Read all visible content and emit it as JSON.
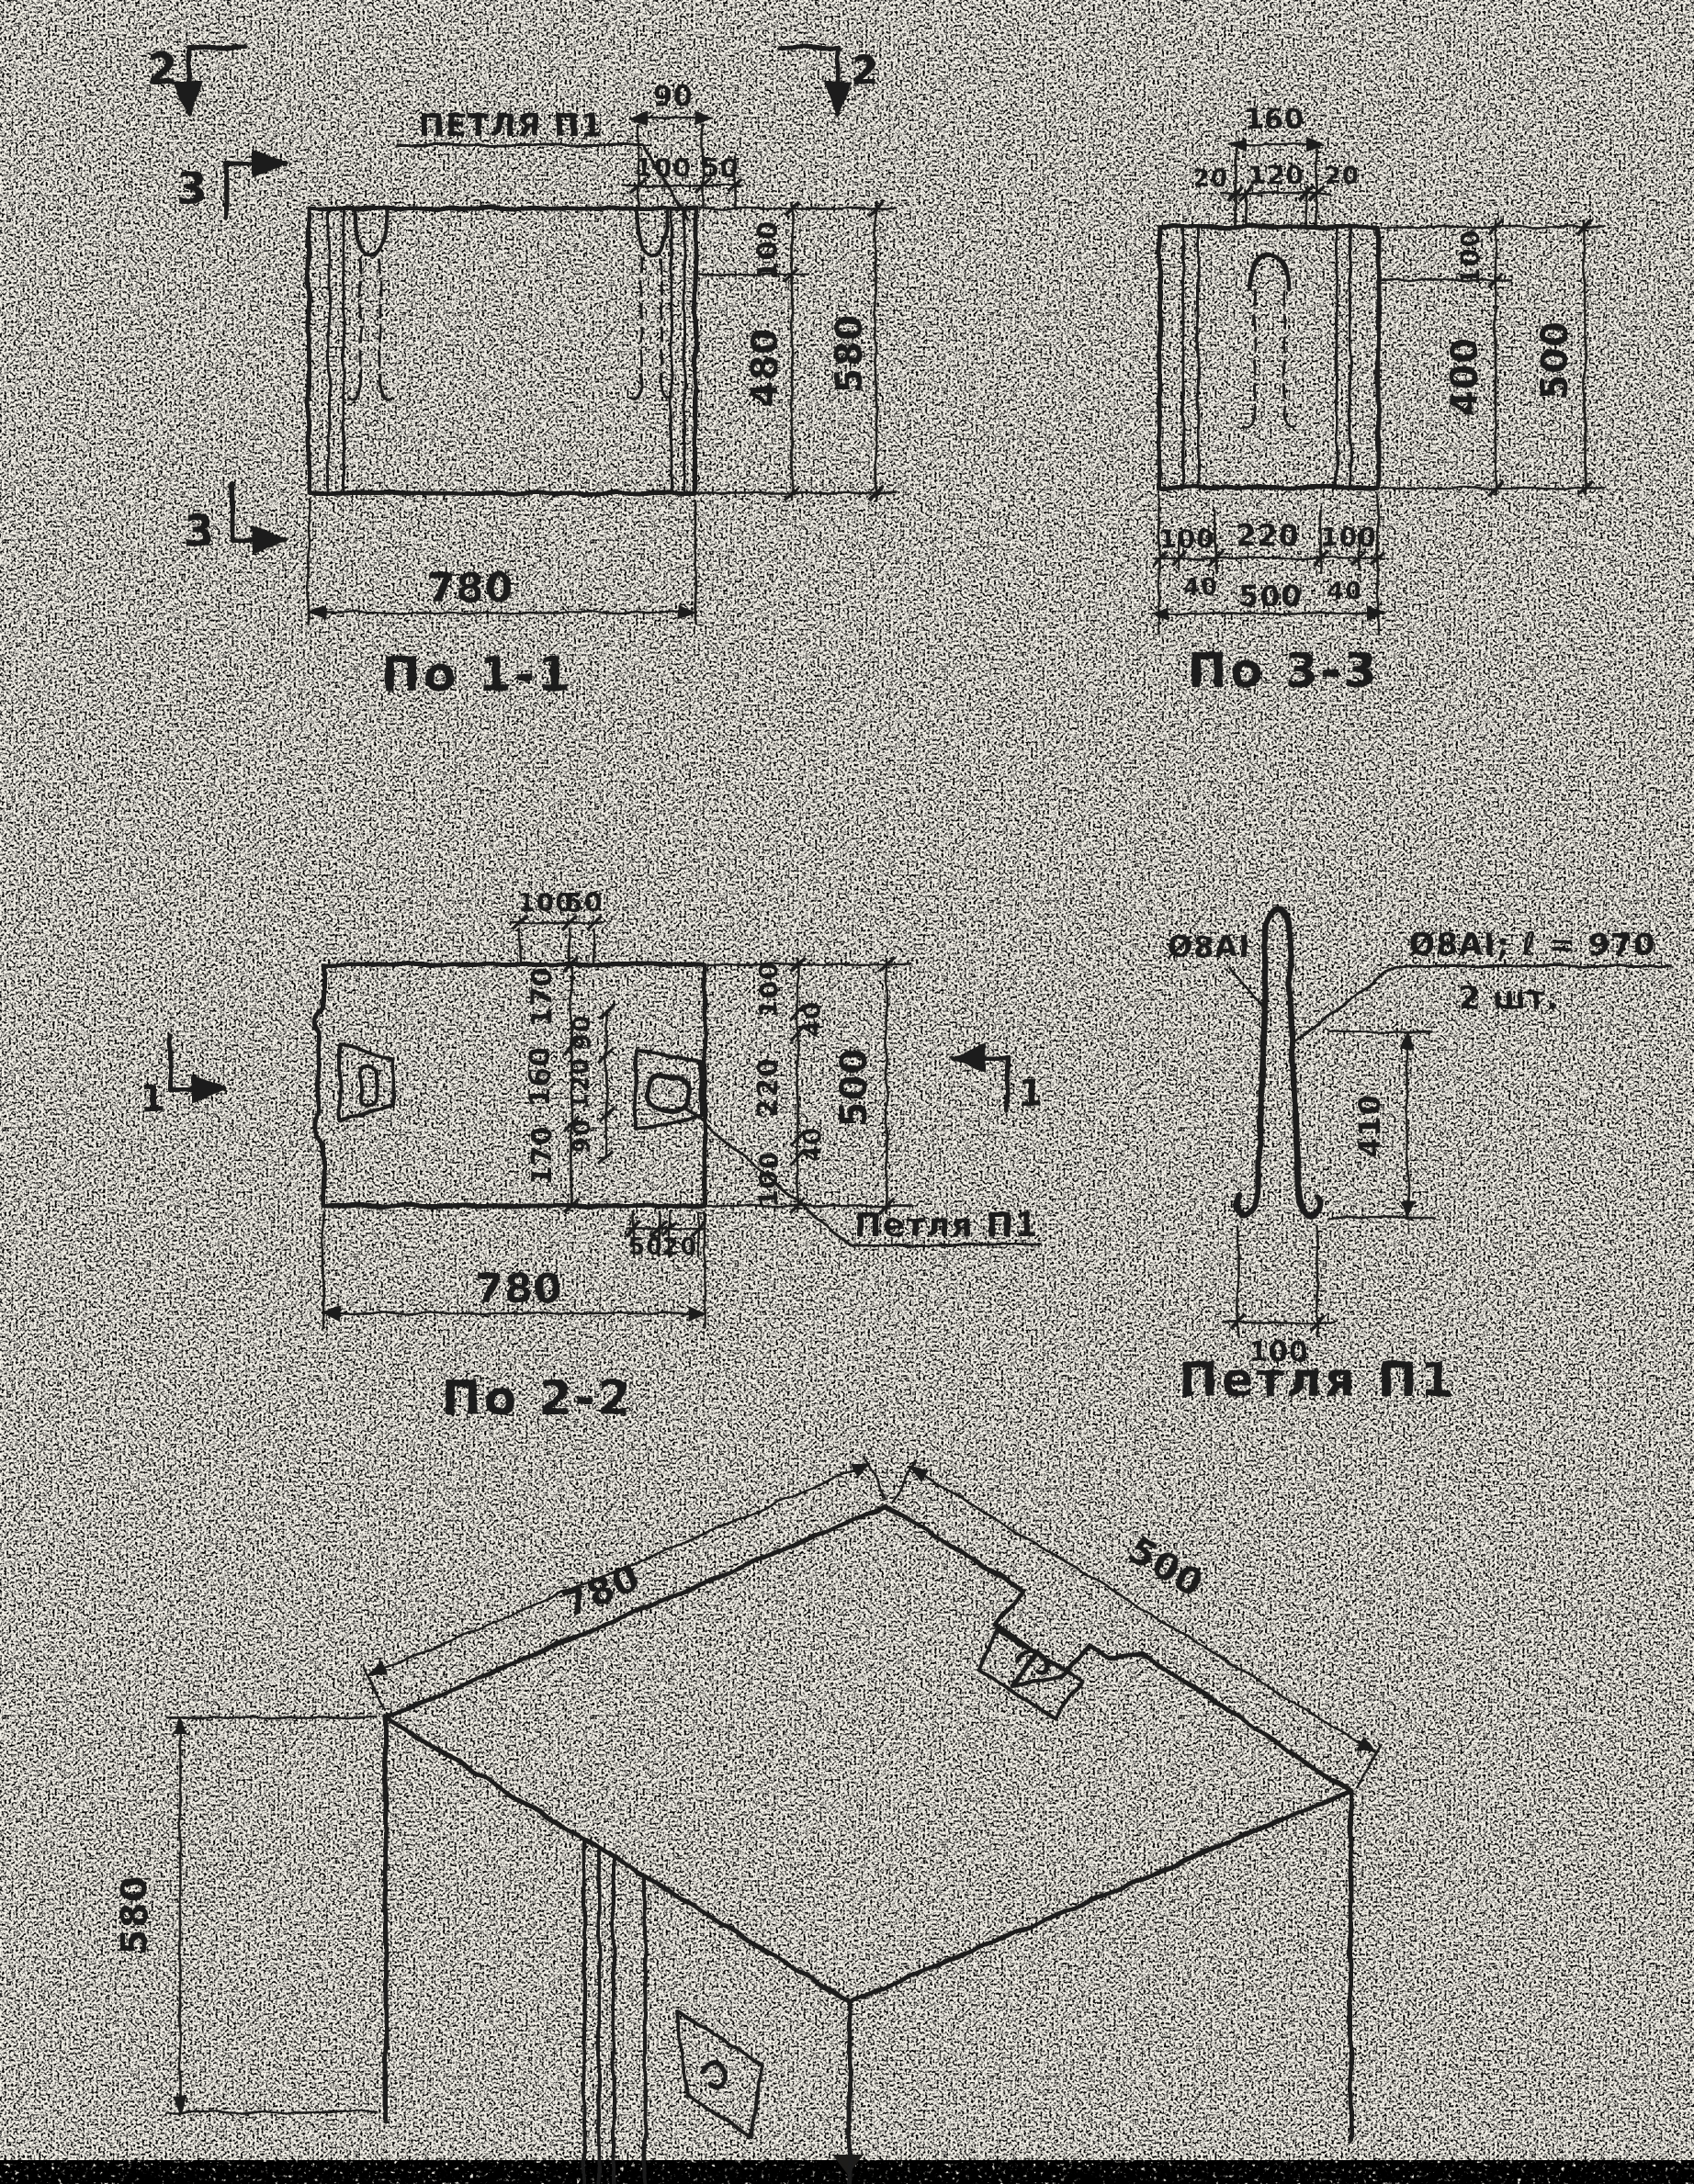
{
  "page": {
    "paper": "#f4f1e8",
    "ink": "#1d1c1a"
  },
  "s11": {
    "title": "По 1-1",
    "loop": "ПЕТЛЯ П1",
    "m2l": "2",
    "m2r": "2",
    "m3t": "3",
    "m3b": "3",
    "d90": "90",
    "d100": "100",
    "d50": "50",
    "r100": "100",
    "r480": "480",
    "r580": "580",
    "b780": "780"
  },
  "s33": {
    "title": "По 3-3",
    "t160": "160",
    "t20l": "20",
    "t120": "120",
    "t20r": "20",
    "r100": "100",
    "r400": "400",
    "r500": "500",
    "b100l": "100",
    "b220": "220",
    "b100r": "100",
    "b40l": "40",
    "b40r": "40",
    "b500": "500"
  },
  "s22": {
    "title": "По 2-2",
    "loop": "Петля П1",
    "m1l": "1",
    "m1r": "1",
    "t100": "100",
    "t50": "50",
    "i170a": "170",
    "i160": "160",
    "i170b": "170",
    "n90a": "90",
    "n120": "120",
    "n90b": "90",
    "r100a": "100",
    "r40a": "40",
    "r220": "220",
    "r40b": "40",
    "r100b": "100",
    "r500": "500",
    "tab50": "50",
    "tab20": "20",
    "b780": "780"
  },
  "loop": {
    "title": "Петля П1",
    "mark": "Ø8АI",
    "callout1": "Ø8АI; ℓ = 970",
    "callout2": "2 шт.",
    "h410": "410",
    "w100": "100"
  },
  "iso": {
    "l780": "780",
    "w500": "500",
    "h580": "580"
  }
}
